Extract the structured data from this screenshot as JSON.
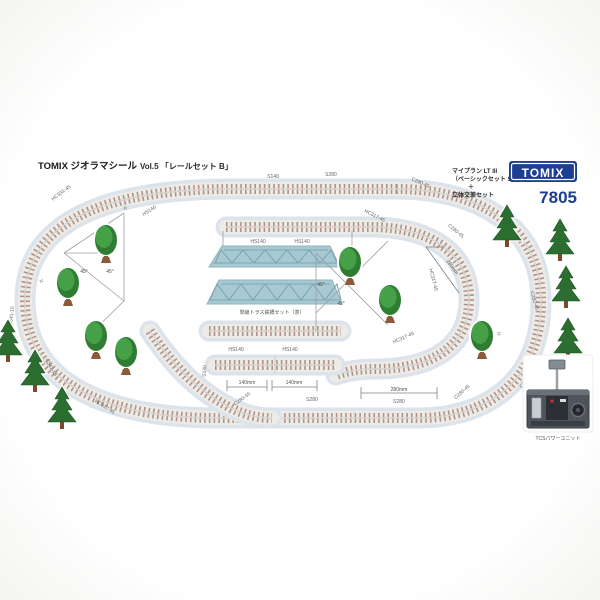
{
  "header": {
    "brand_title": "TOMIX ジオラマシール",
    "volume_title": "Vol.5 「レールセット B」"
  },
  "product": {
    "plan_line1": "マイプラン LT III",
    "plan_line2": "（ベーシックセット SD）",
    "plan_line3": "＋",
    "plan_line4": "立体交差セット",
    "logo_text": "TOMIX",
    "model_number": "7805"
  },
  "track_labels": [
    {
      "text": "HC391-45"
    },
    {
      "text": "S140"
    },
    {
      "text": "S280"
    },
    {
      "text": "C280-45"
    },
    {
      "text": "HC317-45"
    },
    {
      "text": "HS140"
    },
    {
      "text": "HS140"
    },
    {
      "text": "HS140"
    },
    {
      "text": "C541-15"
    },
    {
      "text": "C541-15"
    },
    {
      "text": "HC317-45"
    },
    {
      "text": "C280-45"
    },
    {
      "text": "S280"
    },
    {
      "text": "S140"
    },
    {
      "text": "C280-45"
    },
    {
      "text": "C280-45"
    },
    {
      "text": "C280-45"
    },
    {
      "text": "C280-45"
    },
    {
      "text": "HC317-45"
    },
    {
      "text": "HC317-45"
    },
    {
      "text": "S280"
    },
    {
      "text": "HS140"
    },
    {
      "text": "HS140"
    }
  ],
  "dimensions": {
    "left_a": "140mm",
    "left_b": "140mm",
    "bottom": "280mm",
    "diag": "280mm"
  },
  "angle_labels": [
    "45°",
    "45°",
    "45°",
    "45°"
  ],
  "equals_marks": [
    "=",
    "=",
    "="
  ],
  "center": {
    "bridge_caption": "単線トラス鉄橋セット（茶）"
  },
  "power_unit": {
    "label": "TCSパワーユニット"
  },
  "colors": {
    "brand_blue": "#1d3f92",
    "sticker_base_blue": "#dce3eb",
    "tie_brown": "#b2938c",
    "bridge_blue": "#a7c9d1",
    "tree_green": "#3f9a42",
    "conifer_green": "#2c6e2f"
  }
}
